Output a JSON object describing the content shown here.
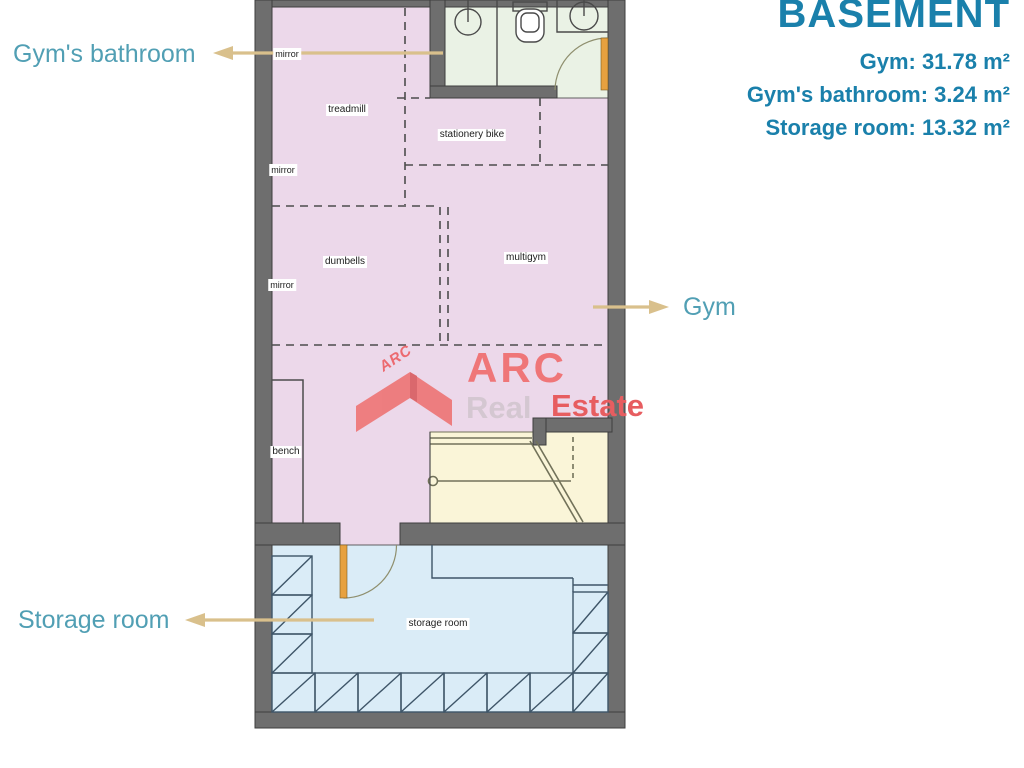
{
  "title_block": {
    "title": "BASEMENT",
    "lines": [
      "Gym: 31.78 m²",
      "Gym's bathroom: 3.24 m²",
      "Storage room: 13.32 m²"
    ]
  },
  "rooms": [
    {
      "name": "Gym",
      "area_m2": "31.78"
    },
    {
      "name": "Gym's bathroom",
      "area_m2": "3.24"
    },
    {
      "name": "Storage room",
      "area_m2": "13.32"
    }
  ],
  "callouts": {
    "bathroom": "Gym's bathroom",
    "gym": "Gym",
    "storage": "Storage room"
  },
  "plan": {
    "equipment": [
      "mirror",
      "treadmill",
      "stationery bike",
      "mirror",
      "dumbells",
      "multigym",
      "mirror",
      "bench",
      "storage room"
    ]
  },
  "watermark": {
    "badge": "ARC",
    "brand": "ARC",
    "word_real": "Real",
    "word_estate": "Estate"
  },
  "colors": {
    "title_text": "#1a80ab",
    "callout_text": "#519fb4",
    "leader_arrow": "#d9c08c",
    "wall": "#6e6e6e",
    "gym_floor": "#ecd8ea",
    "bathroom_floor": "#eaf2e5",
    "stairs_floor": "#faf5d8",
    "storage_floor": "#daecf7",
    "door": "#e7a13f",
    "watermark_red": "#ee7676"
  }
}
